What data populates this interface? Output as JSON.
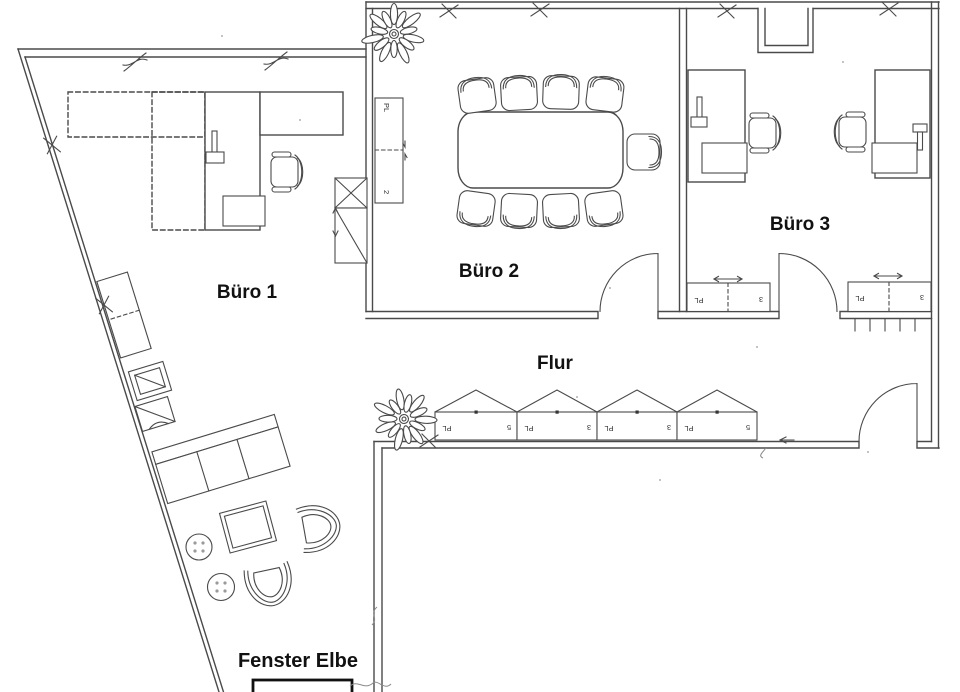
{
  "floorplan": {
    "rooms": {
      "buero1": {
        "label": "Büro 1"
      },
      "buero2": {
        "label": "Büro 2"
      },
      "buero3": {
        "label": "Büro 3"
      },
      "flur": {
        "label": "Flur"
      }
    },
    "window_label": "Fenster Elbe",
    "buero2_sideboard": {
      "label_top": "PL",
      "label_bottom": "2"
    },
    "flur_cabinets": [
      {
        "label_left": "PL",
        "label_right": "5"
      },
      {
        "label_left": "PL",
        "label_right": "3"
      },
      {
        "label_left": "PL",
        "label_right": "3"
      },
      {
        "label_left": "PL",
        "label_right": "5"
      }
    ],
    "buero3_sideboards": [
      {
        "label_left": "PL",
        "label_right": "3"
      },
      {
        "label_left": "PL",
        "label_right": "3"
      }
    ],
    "colors": {
      "line": "#4a4a4a",
      "text": "#111111",
      "pencil": "#8a8a8a",
      "background": "#ffffff"
    }
  }
}
